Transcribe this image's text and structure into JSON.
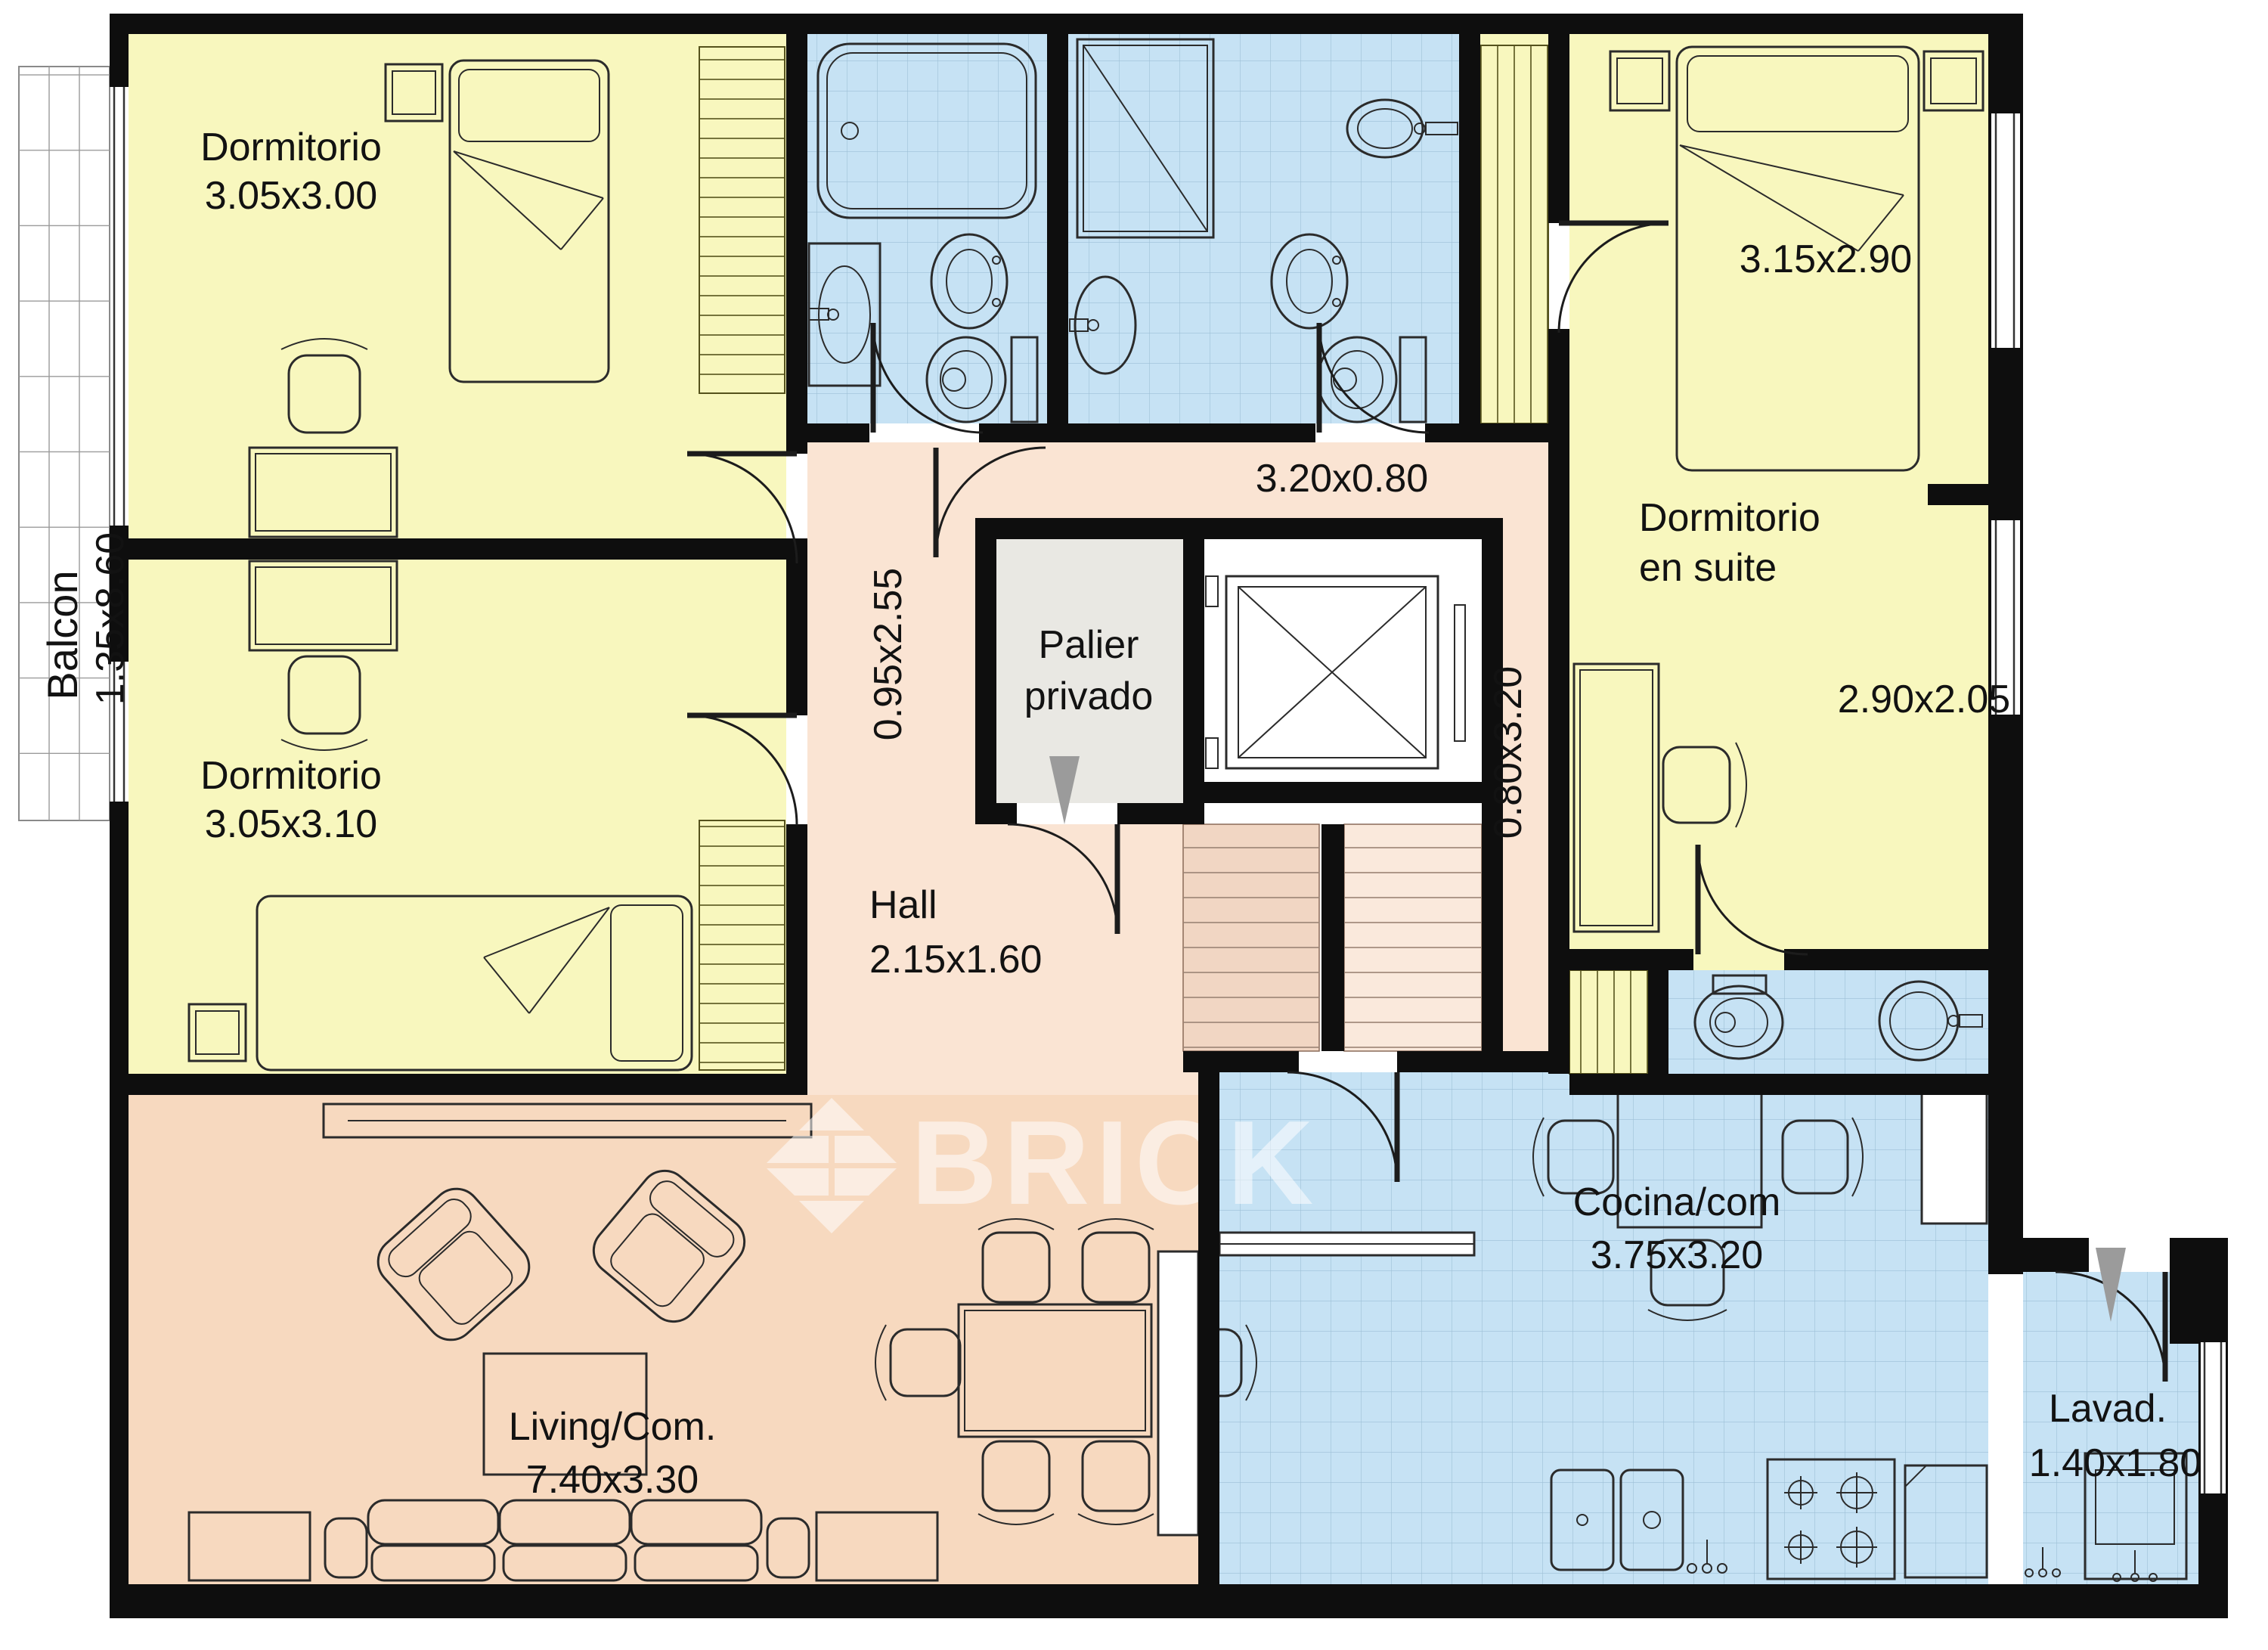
{
  "document": {
    "type": "apartment-floor-plan",
    "watermark_text": "BRICK"
  },
  "colors": {
    "wall": "#0e0e0e",
    "bedroom_yellow": "#f8f7be",
    "wet_area_blue": "#c6e2f4",
    "tile_line_blue": "#9dc0d6",
    "hall_pink": "#fae4d3",
    "living_salmon": "#f7d9bf",
    "palier_gray": "#e9e8e3",
    "stairs_dark": "#f1d6c3",
    "stairs_light": "#fae9dc",
    "entrance_arrow_gray": "#9b9b9b",
    "watermark_white": "#ffffff"
  },
  "rooms": {
    "balcony": {
      "name": "Balcon",
      "dimensions": "1.35x8.60"
    },
    "bedroom1": {
      "name": "Dormitorio",
      "dimensions": "3.05x3.00"
    },
    "bedroom2": {
      "name": "Dormitorio",
      "dimensions": "3.05x3.10"
    },
    "suite": {
      "name_line1": "Dormitorio",
      "name_line2": "en suite",
      "bed_area_dimensions": "3.15x2.90",
      "desk_area_dimensions": "2.90x2.05"
    },
    "corridor_top": {
      "dimensions": "3.20x0.80"
    },
    "corridor_vertical": {
      "dimensions": "0.95x2.55"
    },
    "corridor_right": {
      "dimensions": "0.80x3.20"
    },
    "palier": {
      "name_line1": "Palier",
      "name_line2": "privado"
    },
    "hall": {
      "name": "Hall",
      "dimensions": "2.15x1.60"
    },
    "living": {
      "name": "Living/Com.",
      "dimensions": "7.40x3.30"
    },
    "kitchen": {
      "name": "Cocina/com",
      "dimensions": "3.75x3.20"
    },
    "laundry": {
      "name": "Lavad.",
      "dimensions": "1.40x1.80"
    }
  }
}
